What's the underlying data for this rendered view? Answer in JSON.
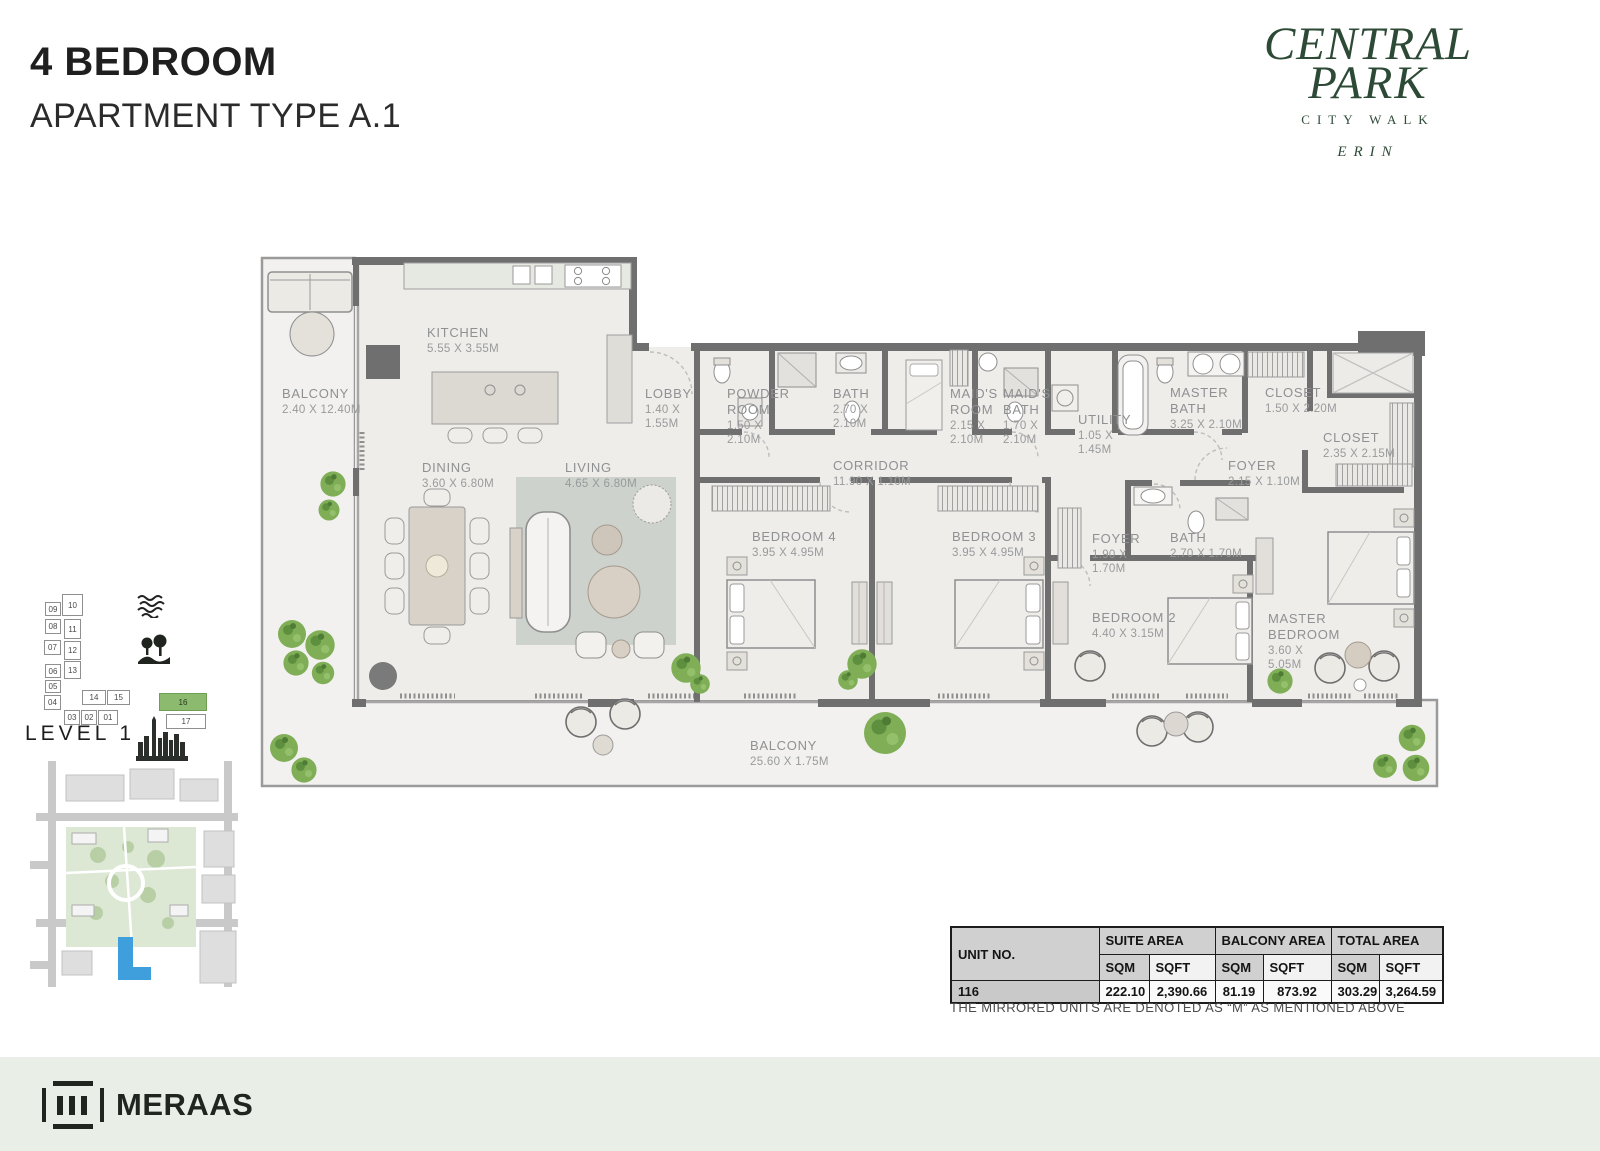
{
  "page": {
    "title_line1": "4 BEDROOM",
    "title_line2": "APARTMENT TYPE A.1"
  },
  "brand": {
    "line1": "CENTRAL",
    "line2": "PARK",
    "sub": "CITY WALK",
    "collection": "ERIN",
    "color": "#2d4a36"
  },
  "plan": {
    "rooms": [
      {
        "name": "BALCONY",
        "dims": "2.40 X  12.40M",
        "x": 282,
        "y": 386
      },
      {
        "name": "KITCHEN",
        "dims": "5.55 X 3.55M",
        "x": 427,
        "y": 325
      },
      {
        "name": "LOBBY",
        "dims": "1.40 X\n1.55M",
        "x": 645,
        "y": 386
      },
      {
        "name": "POWDER\nROOM",
        "dims": "1.50 X\n2.10M",
        "x": 727,
        "y": 386
      },
      {
        "name": "BATH",
        "dims": "2.70 X\n2.10M",
        "x": 833,
        "y": 386
      },
      {
        "name": "MAID'S\nROOM",
        "dims": "2.15 X\n2.10M",
        "x": 950,
        "y": 386
      },
      {
        "name": "MAID'S\nBATH",
        "dims": "1.70 X\n2.10M",
        "x": 1003,
        "y": 386
      },
      {
        "name": "UTILITY",
        "dims": "1.05 X\n1.45M",
        "x": 1078,
        "y": 412
      },
      {
        "name": "MASTER\nBATH",
        "dims": "3.25 X 2.10M",
        "x": 1170,
        "y": 385
      },
      {
        "name": "CLOSET",
        "dims": "1.50 X 2.20M",
        "x": 1265,
        "y": 385
      },
      {
        "name": "CLOSET",
        "dims": "2.35 X 2.15M",
        "x": 1323,
        "y": 430
      },
      {
        "name": "CORRIDOR",
        "dims": "11.90 X 1.10M",
        "x": 833,
        "y": 458
      },
      {
        "name": "FOYER",
        "dims": "2.15 X 1.10M",
        "x": 1228,
        "y": 458
      },
      {
        "name": "DINING",
        "dims": "3.60 X 6.80M",
        "x": 422,
        "y": 460
      },
      {
        "name": "LIVING",
        "dims": "4.65 X 6.80M",
        "x": 565,
        "y": 460
      },
      {
        "name": "BEDROOM 4",
        "dims": "3.95 X 4.95M",
        "x": 752,
        "y": 529
      },
      {
        "name": "BEDROOM 3",
        "dims": "3.95 X 4.95M",
        "x": 952,
        "y": 529
      },
      {
        "name": "FOYER",
        "dims": "1.90 X\n1.70M",
        "x": 1092,
        "y": 531
      },
      {
        "name": "BATH",
        "dims": "2.70 X 1.70M",
        "x": 1170,
        "y": 530
      },
      {
        "name": "BEDROOM 2",
        "dims": "4.40 X 3.15M",
        "x": 1092,
        "y": 610
      },
      {
        "name": "MASTER\nBEDROOM",
        "dims": "3.60 X\n5.05M",
        "x": 1268,
        "y": 611
      },
      {
        "name": "BALCONY",
        "dims": "25.60 X 1.75M",
        "x": 750,
        "y": 738
      }
    ]
  },
  "level_map": {
    "label": "LEVEL 1",
    "highlight_color": "#8cba6e",
    "highlighted_unit": "16",
    "units": [
      {
        "id": "09",
        "x": 45,
        "y": 602,
        "w": 16,
        "h": 14
      },
      {
        "id": "08",
        "x": 45,
        "y": 619,
        "w": 16,
        "h": 15
      },
      {
        "id": "07",
        "x": 44,
        "y": 640,
        "w": 17,
        "h": 15
      },
      {
        "id": "06",
        "x": 45,
        "y": 664,
        "w": 16,
        "h": 14
      },
      {
        "id": "05",
        "x": 45,
        "y": 680,
        "w": 16,
        "h": 13
      },
      {
        "id": "04",
        "x": 44,
        "y": 695,
        "w": 17,
        "h": 15
      },
      {
        "id": "10",
        "x": 62,
        "y": 594,
        "w": 21,
        "h": 22
      },
      {
        "id": "11",
        "x": 64,
        "y": 619,
        "w": 17,
        "h": 20
      },
      {
        "id": "12",
        "x": 64,
        "y": 641,
        "w": 17,
        "h": 19
      },
      {
        "id": "13",
        "x": 64,
        "y": 661,
        "w": 17,
        "h": 18
      },
      {
        "id": "14",
        "x": 82,
        "y": 690,
        "w": 24,
        "h": 15
      },
      {
        "id": "15",
        "x": 107,
        "y": 690,
        "w": 23,
        "h": 15
      },
      {
        "id": "03",
        "x": 64,
        "y": 710,
        "w": 16,
        "h": 15
      },
      {
        "id": "02",
        "x": 81,
        "y": 710,
        "w": 16,
        "h": 15
      },
      {
        "id": "01",
        "x": 98,
        "y": 710,
        "w": 20,
        "h": 15
      },
      {
        "id": "16",
        "x": 159,
        "y": 693,
        "w": 48,
        "h": 18,
        "highlighted": true
      },
      {
        "id": "17",
        "x": 166,
        "y": 714,
        "w": 40,
        "h": 15
      }
    ],
    "icons": [
      "water-icon",
      "park-icon",
      "skyline-icon"
    ]
  },
  "areas_table": {
    "col_unit": "UNIT NO.",
    "group_headers": [
      "SUITE AREA",
      "BALCONY AREA",
      "TOTAL AREA"
    ],
    "sub_headers": [
      "SQM",
      "SQFT"
    ],
    "row": {
      "unit": "116",
      "values": [
        "222.10",
        "2,390.66",
        "81.19",
        "873.92",
        "303.29",
        "3,264.59"
      ]
    }
  },
  "note": "THE MIRRORED UNITS ARE DENOTED AS “M” AS MENTIONED ABOVE",
  "footer": {
    "brand": "MERAAS"
  },
  "colors": {
    "wall": "#6f6f6f",
    "floor": "#efedea",
    "balcony_floor": "#f2f1ef",
    "plant_green": "#7fae57",
    "highlight_building_blue": "#3f9fdd",
    "footer_bg": "#e9efe7"
  }
}
